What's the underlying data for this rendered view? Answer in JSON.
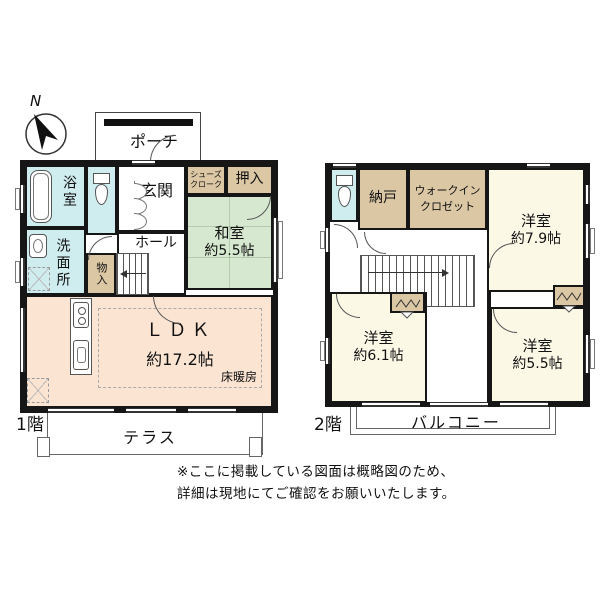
{
  "compass": {
    "north_label": "N"
  },
  "floor1": {
    "floor_label": "1階",
    "porch": "ポーチ",
    "bath": "浴室",
    "toilet": "",
    "washroom": "洗面所",
    "entrance": "玄関",
    "hall": "ホール",
    "shoes_closet": "シューズクローク",
    "oshiire": "押入",
    "washitsu_name": "和室",
    "washitsu_size": "約5.5帖",
    "mono_ire": "物入",
    "ldk_name": "ＬＤＫ",
    "ldk_size": "約17.2帖",
    "floor_heating": "床暖房",
    "terrace": "テラス"
  },
  "floor2": {
    "floor_label": "2階",
    "nando": "納戸",
    "walk_in_closet": "ウォークインクロゼット",
    "room79_name": "洋室",
    "room79_size": "約7.9帖",
    "room61_name": "洋室",
    "room61_size": "約6.1帖",
    "room55_name": "洋室",
    "room55_size": "約5.5帖",
    "balcony": "バルコニー"
  },
  "note": {
    "line1": "※ここに掲載している図面は概略図のため、",
    "line2": "詳細は現地にてご確認をお願いいたします。"
  },
  "colors": {
    "wall": "#161616",
    "wet_area_blue": "#cfecef",
    "closet_tan": "#dbc7a4",
    "tatami_green": "#d7e8d0",
    "ldk_peach": "#fce4d2",
    "western_cream": "#fbf8e6"
  }
}
